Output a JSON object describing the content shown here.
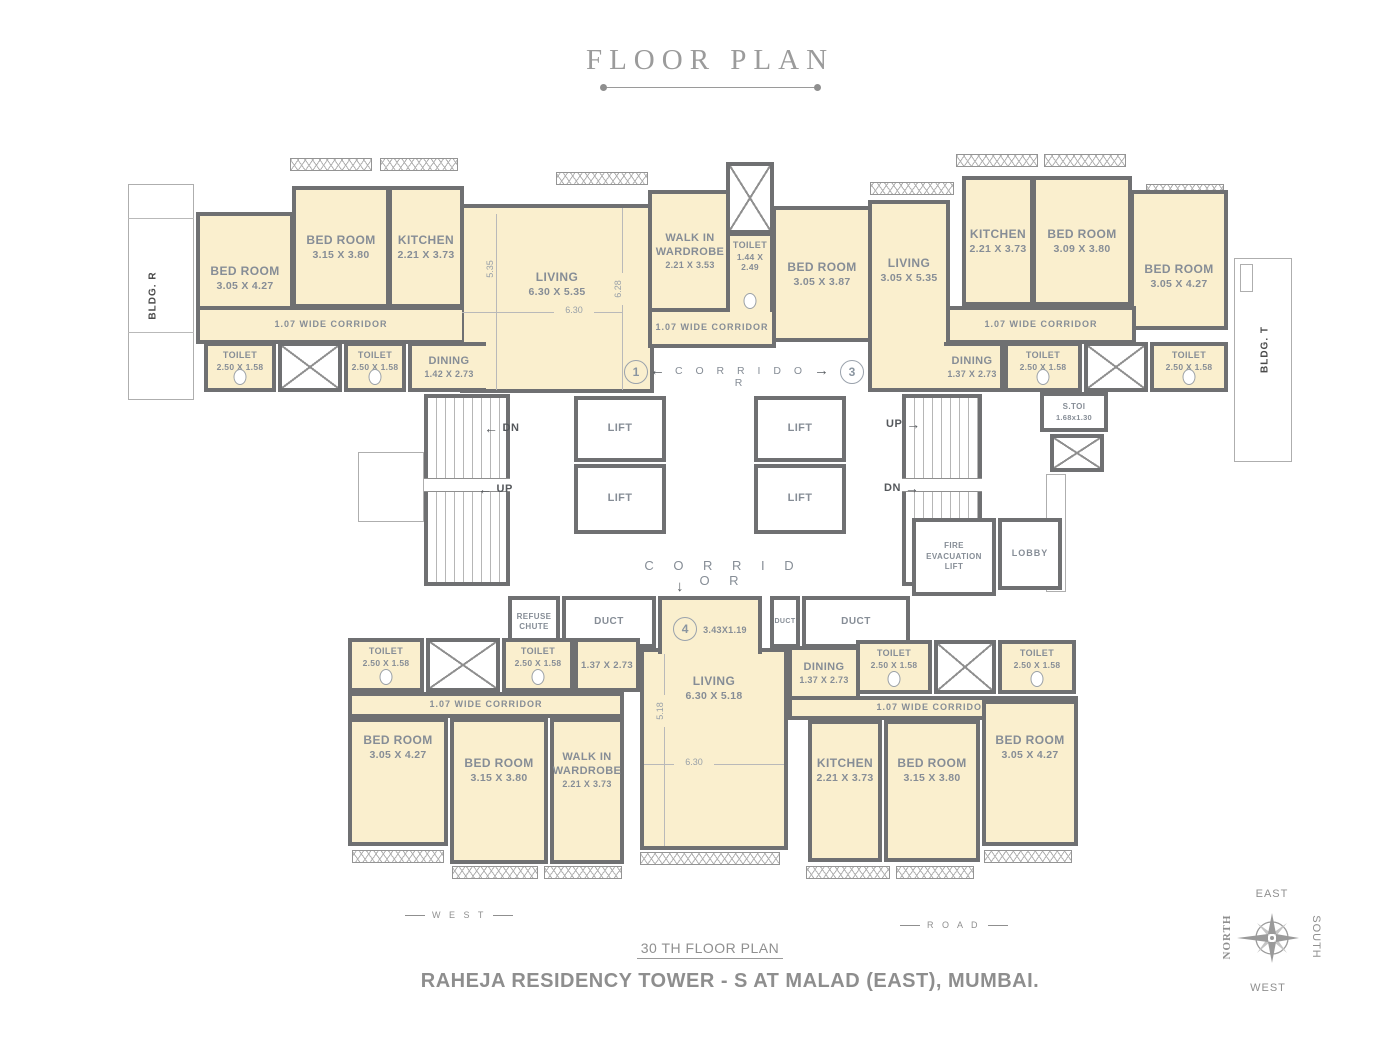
{
  "title": "FLOOR PLAN",
  "labels": {
    "corridor": "C O R R I D O R",
    "wide_corridor": "1.07 WIDE CORRIDOR",
    "bldg_r": "BLDG. R",
    "bldg_t": "BLDG. T"
  },
  "arrows": {
    "left": "←",
    "right": "→",
    "down": "↓"
  },
  "badges": {
    "u1": "1",
    "u3": "3",
    "u4": "4"
  },
  "rooms": {
    "tl": {
      "bed1": {
        "name": "BED ROOM",
        "dim": "3.05 X 4.27"
      },
      "bed2": {
        "name": "BED ROOM",
        "dim": "3.15 X 3.80"
      },
      "kitchen": {
        "name": "KITCHEN",
        "dim": "2.21 X 3.73"
      },
      "living": {
        "name": "LIVING",
        "dim": "6.30 X 5.35"
      },
      "dining": {
        "name": "DINING",
        "dim": "1.42 X 2.73"
      },
      "toilet1": {
        "name": "TOILET",
        "dim": "2.50 X 1.58"
      },
      "toilet2": {
        "name": "TOILET",
        "dim": "2.50 X 1.58"
      }
    },
    "mid": {
      "wardrobe": {
        "name": "WALK IN WARDROBE",
        "dim": "2.21 X 3.53"
      },
      "toilet": {
        "name": "TOILET",
        "dim": "1.44 X 2.49"
      },
      "bed": {
        "name": "BED ROOM",
        "dim": "3.05 X 3.87"
      }
    },
    "tr": {
      "living": {
        "name": "LIVING",
        "dim": "3.05 X 5.35"
      },
      "kitchen": {
        "name": "KITCHEN",
        "dim": "2.21 X 3.73"
      },
      "bed1": {
        "name": "BED ROOM",
        "dim": "3.09 X 3.80"
      },
      "bed2": {
        "name": "BED ROOM",
        "dim": "3.05 X 4.27"
      },
      "dining": {
        "name": "DINING",
        "dim": "1.37 X 2.73"
      },
      "toilet1": {
        "name": "TOILET",
        "dim": "2.50 X 1.58"
      },
      "toilet2": {
        "name": "TOILET",
        "dim": "2.50 X 1.58"
      }
    },
    "bl": {
      "toilet1": {
        "name": "TOILET",
        "dim": "2.50 X 1.58"
      },
      "toilet2": {
        "name": "TOILET",
        "dim": "2.50 X 1.58"
      },
      "dining_dim": "1.37 X 2.73",
      "bed1": {
        "name": "BED ROOM",
        "dim": "3.05 X 4.27"
      },
      "bed2": {
        "name": "BED ROOM",
        "dim": "3.15 X 3.80"
      },
      "wardrobe": {
        "name": "WALK IN WARDROBE",
        "dim": "2.21 X 3.73"
      }
    },
    "bc": {
      "living": {
        "name": "LIVING",
        "dim": "6.30 X 5.18"
      }
    },
    "br": {
      "dining": {
        "name": "DINING",
        "dim": "1.37 X 2.73"
      },
      "toilet1": {
        "name": "TOILET",
        "dim": "2.50 X 1.58"
      },
      "toilet2": {
        "name": "TOILET",
        "dim": "2.50 X 1.58"
      },
      "kitchen": {
        "name": "KITCHEN",
        "dim": "2.21 X 3.73"
      },
      "bed1": {
        "name": "BED ROOM",
        "dim": "3.15 X 3.80"
      },
      "bed2": {
        "name": "BED ROOM",
        "dim": "3.05 X 4.27"
      }
    }
  },
  "core": {
    "lift": "LIFT",
    "up": "UP",
    "dn": "DN",
    "stoi_name": "S.TOI",
    "stoi_dim": "1.68x1.30",
    "fire_lift": "FIRE EVACUATION LIFT",
    "lobby": "LOBBY",
    "refuse": "REFUSE CHUTE",
    "duct": "DUCT",
    "entry_dim": "3.43X1.19"
  },
  "dims": {
    "v535": "5.35",
    "h630": "6.30",
    "v628": "6.28",
    "v518": "5.18",
    "h630b": "6.30"
  },
  "footer": {
    "west": "W E S T",
    "road": "R O A D",
    "floor": "30 TH  FLOOR PLAN",
    "project": "RAHEJA RESIDENCY TOWER - S  AT MALAD (EAST), MUMBAI."
  },
  "compass": {
    "north": "NORTH",
    "east": "EAST",
    "south": "SOUTH",
    "west": "WEST"
  },
  "colors": {
    "room_fill": "#FAEFCE",
    "wall": "#6F7072",
    "label": "#868D96",
    "title": "#9B9B9B"
  }
}
